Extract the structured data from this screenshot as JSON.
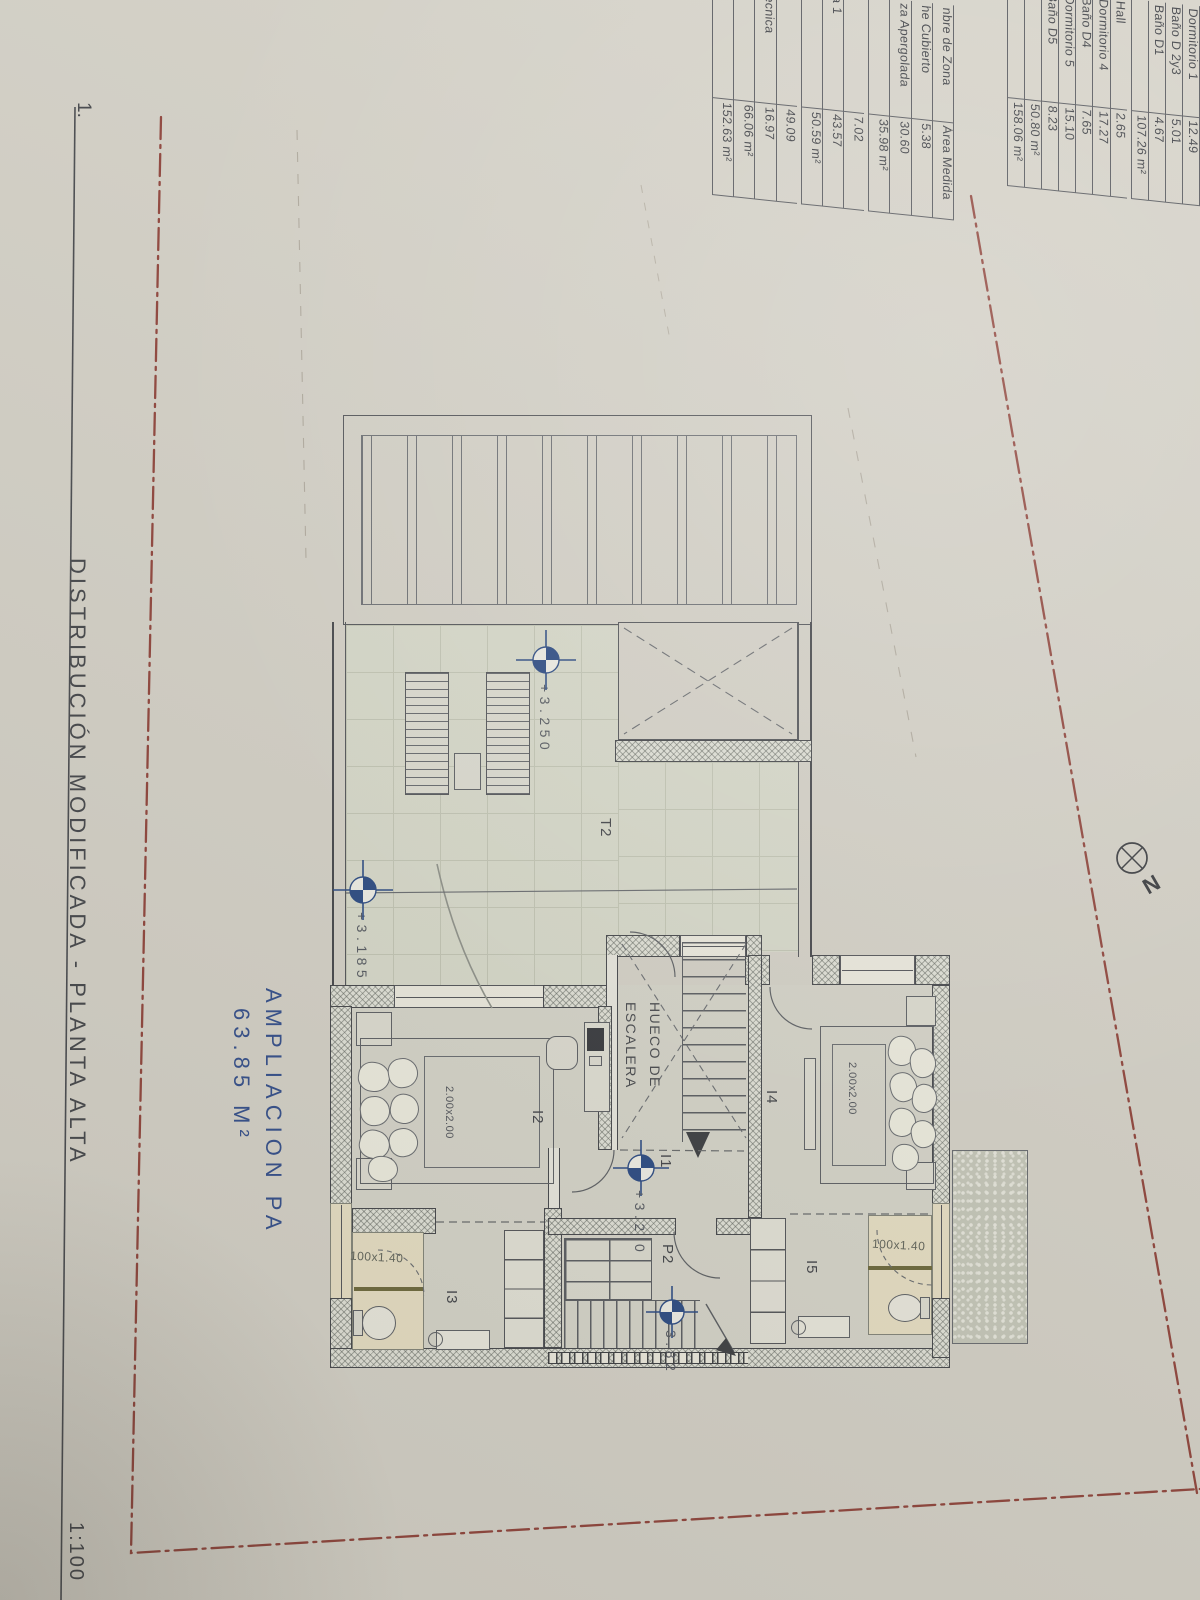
{
  "sheet": {
    "number_label": "1.",
    "title": "DISTRIBUCIÓN MODIFICADA - PLANTA ALTA",
    "scale": "1:100"
  },
  "compass": {
    "label": "N"
  },
  "annotation": {
    "line1": "AMPLIACION PA",
    "line2": "63.85 M²"
  },
  "area_table_right": {
    "rows": [
      {
        "name": "Dormitorio 1",
        "value": "12.49"
      },
      {
        "name": "Baño D 2y3",
        "value": "5.01"
      },
      {
        "name": "Baño D1",
        "value": "4.67"
      },
      {
        "name": "",
        "value": "107.26 m²"
      },
      {
        "name": "Hall",
        "value": "2.65",
        "gap_before": true
      },
      {
        "name": "Dormitorio 4",
        "value": "17.27"
      },
      {
        "name": "Baño D4",
        "value": "7.65"
      },
      {
        "name": "Dormitorio 5",
        "value": "15.10"
      },
      {
        "name": "Baño D5",
        "value": "8.23"
      },
      {
        "name": "",
        "value": "50.80 m²"
      },
      {
        "name": "",
        "value": "158.06 m²"
      }
    ]
  },
  "area_table_left": {
    "rows": [
      {
        "name": "nbre de Zona",
        "value": "Área Medida",
        "header": true
      },
      {
        "name": "he Cubierto",
        "value": "5.38"
      },
      {
        "name": "za Apergolada",
        "value": "30.60"
      },
      {
        "name": "",
        "value": "35.98 m²"
      },
      {
        "name": "",
        "value": "7.02",
        "gap_before": true
      },
      {
        "name": "a 1",
        "value": "43.57"
      },
      {
        "name": "",
        "value": "50.59 m²"
      },
      {
        "name": "2",
        "value": "49.09",
        "gap_before": true
      },
      {
        "name": "Tecnica",
        "value": "16.97"
      },
      {
        "name": "",
        "value": "66.06 m²"
      },
      {
        "name": "",
        "value": "152.63 m²"
      }
    ]
  },
  "rooms": {
    "terrace": "T2",
    "bedroom_left": "I2",
    "bath_left": "I3",
    "bedroom_right": "I4",
    "bath_right": "I5",
    "stair_room": "P2",
    "hall": "I1",
    "stairwell_line1": "HUECO DE",
    "stairwell_line2": "ESCALERA"
  },
  "dimensions": {
    "bed_left": "2.00x2.00",
    "bed_right": "2.00x2.00",
    "window_left": "100x1.40",
    "window_right": "100x1.40"
  },
  "elevations": {
    "terrace_main": "+3.250",
    "terrace_low": "+3.185",
    "hall_main": "+3.2",
    "hall_tail": "0",
    "stair": "3.82"
  },
  "colors": {
    "paper": "#d5d2c8",
    "tile": "#d8dacb",
    "wall_line": "#47494d",
    "marker_blue": "#2e4d85",
    "annotation_blue": "#35508c",
    "boundary_red": "#8b3a31",
    "window_beige": "#e7dfc4"
  }
}
